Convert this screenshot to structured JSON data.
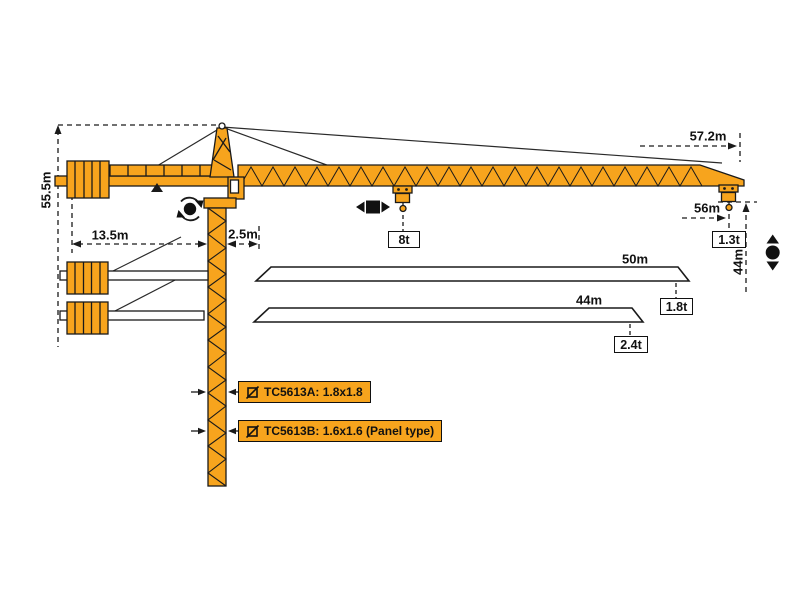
{
  "dims": {
    "total_height": "55.5m",
    "counter_jib_radius": "13.5m",
    "jib_offset": "2.5m",
    "max_radius": "57.2m",
    "tip_hook_radius": "56m",
    "hook_height": "44m"
  },
  "loads": {
    "max_load": "8t",
    "tip_load": "1.3t"
  },
  "jib_variants": [
    {
      "length": "50m",
      "tip_load": "1.8t"
    },
    {
      "length": "44m",
      "tip_load": "2.4t"
    }
  ],
  "models": [
    {
      "label": "TC5613A: 1.8x1.8"
    },
    {
      "label": "TC5613B: 1.6x1.6 (Panel type)"
    }
  ],
  "colors": {
    "crane_orange": "#F7A41D",
    "outline": "#1a1a1a",
    "background": "#ffffff"
  }
}
